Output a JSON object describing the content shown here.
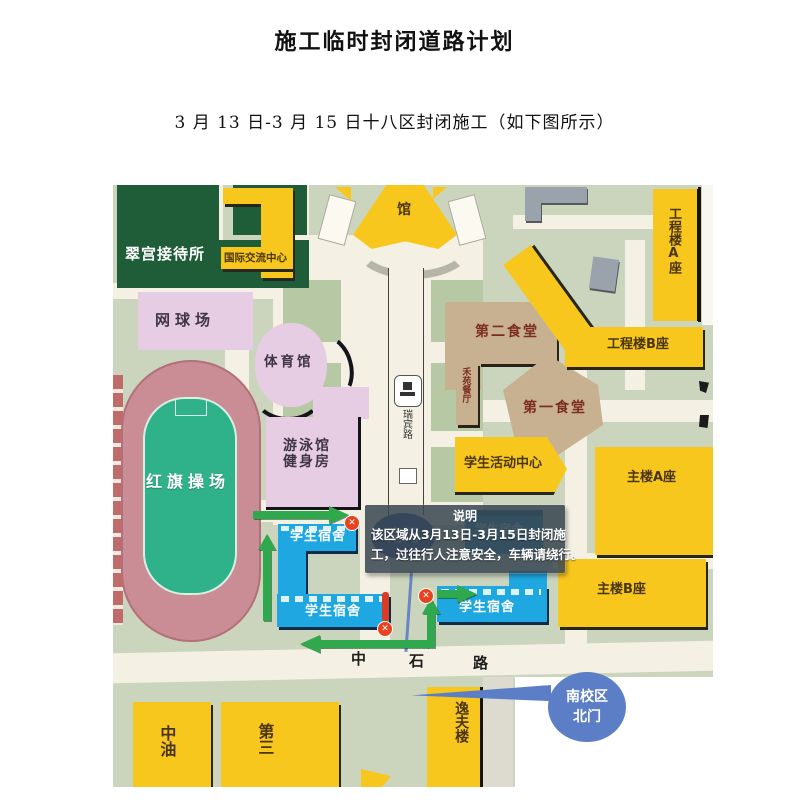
{
  "page": {
    "title": "施工临时封闭道路计划",
    "subtitle": "3 月 13 日-3 月 15 日十八区封闭施工（如下图所示）"
  },
  "map": {
    "buildings": {
      "cuigong": "翠宫接待所",
      "intl_center": "国际交流中心",
      "tennis": "网球场",
      "gym": "体育馆",
      "pool_l1": "游泳馆",
      "pool_l2": "健身房",
      "playground": "红旗操场",
      "hall": "馆",
      "canteen2": "第二食堂",
      "heyuan": "禾苑餐厅",
      "canteen1": "第一食堂",
      "activity_center": "学生活动中心",
      "eng_a": "工程楼A座",
      "eng_b": "工程楼B座",
      "main_a": "主楼A座",
      "main_b": "主楼B座",
      "dorm": "学生宿舍",
      "yifu": "逸夫楼",
      "zhongyou": "中油",
      "di_san": "第三"
    },
    "roads": {
      "central_path": "瑞宾路",
      "zhongshi": [
        "中",
        "石",
        "路"
      ]
    },
    "gates": {
      "south_hidden": "南门",
      "north_l1": "南校区",
      "north_l2": "北门"
    },
    "note": {
      "heading": "说明",
      "line1": "该区域从3月13日-3月15日封闭施",
      "line2": "工，过往行人注意安全，车辆请绕行。"
    },
    "icons": {
      "closure_x": "✕"
    },
    "colors": {
      "ground": "#cbd5bd",
      "road": "#f4f1e4",
      "yellow_building": "#f8c71d",
      "pink_building": "#e7cde3",
      "tan_building": "#c8b191",
      "green_building": "#1f5c38",
      "dorm_blue": "#1ea7e0",
      "arrow_green": "#2fa84e",
      "closure_red": "#e8421f",
      "note_bg": "#3a4852",
      "gate_blue": "#5b7ec6",
      "field_green": "#2fb189",
      "track_red": "#ca8d96"
    }
  }
}
